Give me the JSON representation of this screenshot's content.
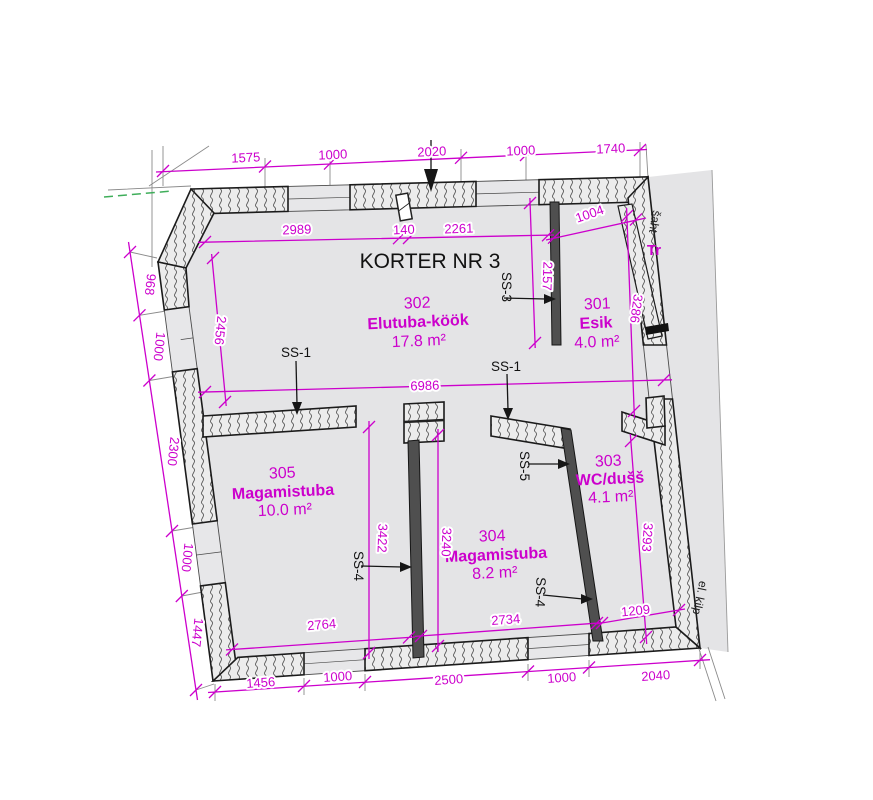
{
  "drawing": {
    "title": "KORTER NR 3",
    "annotations": {
      "shaft": "šaht",
      "stairwell": "Tr",
      "electrical_panel": "el. kilp"
    },
    "rooms": [
      {
        "number": "302",
        "name": "Elutuba-köök",
        "area": "17.8 m²"
      },
      {
        "number": "301",
        "name": "Esik",
        "area": "4.0 m²"
      },
      {
        "number": "303",
        "name": "WC/dušš",
        "area": "4.1 m²"
      },
      {
        "number": "304",
        "name": "Magamistuba",
        "area": "8.2 m²"
      },
      {
        "number": "305",
        "name": "Magamistuba",
        "area": "10.0 m²"
      }
    ],
    "wall_labels": [
      "SS-1",
      "SS-1",
      "SS-3",
      "SS-4",
      "SS-4",
      "SS-5"
    ],
    "dimensions": {
      "top": [
        "1575",
        "1000",
        "2020",
        "1000",
        "1740"
      ],
      "top_interior": [
        "2989",
        "140",
        "2261"
      ],
      "left": [
        "968",
        "1000",
        "2300",
        "1000",
        "1447"
      ],
      "bottom": [
        "1456",
        "1000",
        "2500",
        "1000",
        "2040"
      ],
      "interior_widths": {
        "living": "6986",
        "hall_top": "1004",
        "bedroom305": "2764",
        "bedroom304": "2734",
        "wc": "1209"
      },
      "interior_heights": {
        "living_left": "2456",
        "corridor": "2157",
        "hall": "3286",
        "bedroom305": "3422",
        "bedroom304": "3240",
        "wc": "3293"
      }
    },
    "colors": {
      "dimension": "#cc00cc",
      "drawing": "#1b1b1b",
      "utility_line": "#3fae5a"
    }
  }
}
